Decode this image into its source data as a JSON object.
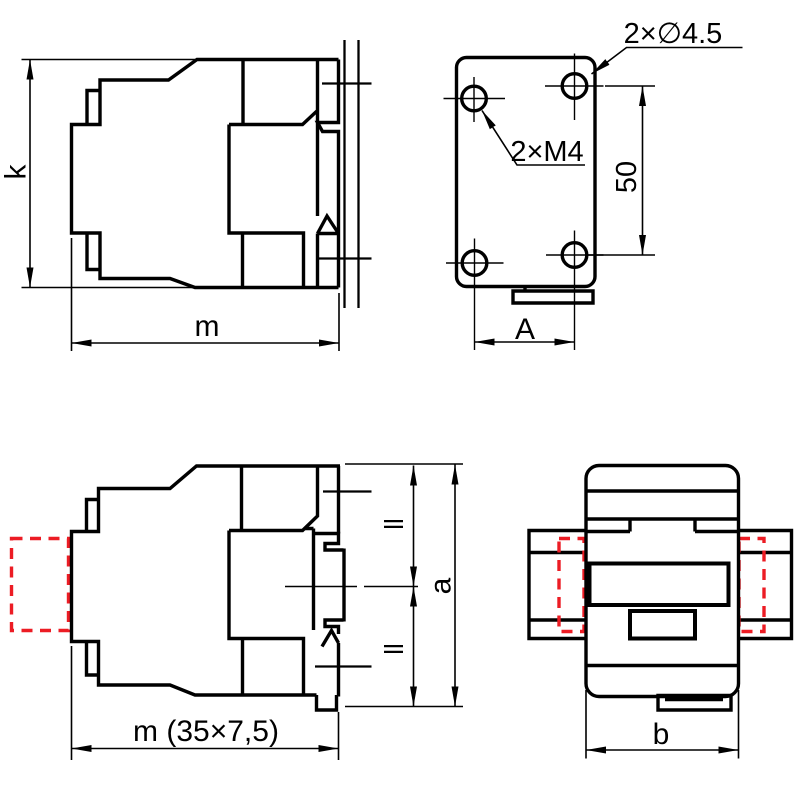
{
  "colors": {
    "line": "#000000",
    "accent": "#ec1c24",
    "bg": "#ffffff"
  },
  "drawing": {
    "type": "contactor-dimensional-drawing",
    "views": {
      "side": {
        "name": "side view",
        "height_label": "k",
        "width_label": "m"
      },
      "plate": {
        "name": "mounting plate rear view",
        "through_holes_label": "2×∅4.5",
        "tapped_holes_label": "2×M4",
        "vertical_hole_spacing": "50",
        "horizontal_hole_spacing": "A"
      },
      "rail": {
        "name": "side view on DIN rail",
        "width_label": "m (35×7,5)",
        "upper_half_label": "ll",
        "lower_half_label": "ll",
        "total_height_label": "a"
      },
      "top": {
        "name": "top view",
        "width_label": "b"
      }
    }
  }
}
